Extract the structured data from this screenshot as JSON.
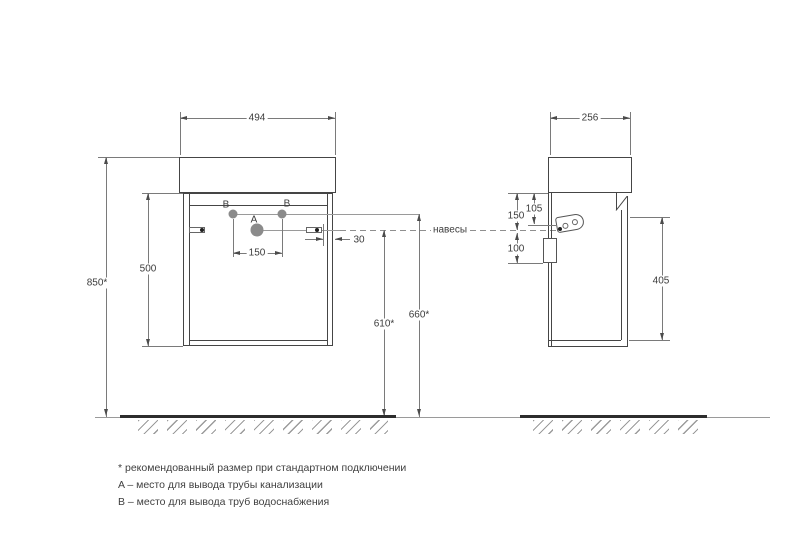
{
  "drawing": {
    "front_view": {
      "width": "494",
      "cabinet_height": "500",
      "mounting_height": "850*",
      "faucet_hole_spacing": "150",
      "hanger_side_offset": "30",
      "drain_outlet_height": "610*",
      "water_outlet_height": "660*",
      "drain_hole_label": "A",
      "water_hole_label": "B"
    },
    "side_view": {
      "depth": "256",
      "hanger_hole_offset": "105",
      "hanger_axis_offset": "150",
      "back_cutout_height": "100",
      "door_height": "405"
    },
    "hangers_label": "навесы",
    "footnotes": [
      "* рекомендованный размер при стандартном подключении",
      "A – место для вывода трубы канализации",
      "B – место для вывода труб водоснабжения"
    ]
  },
  "colors": {
    "line": "#454545",
    "dimension_line": "#7a7a7a",
    "text": "#3c3c3c",
    "floor": "#2d2d2d",
    "hole_fill": "#8b8b8b"
  }
}
